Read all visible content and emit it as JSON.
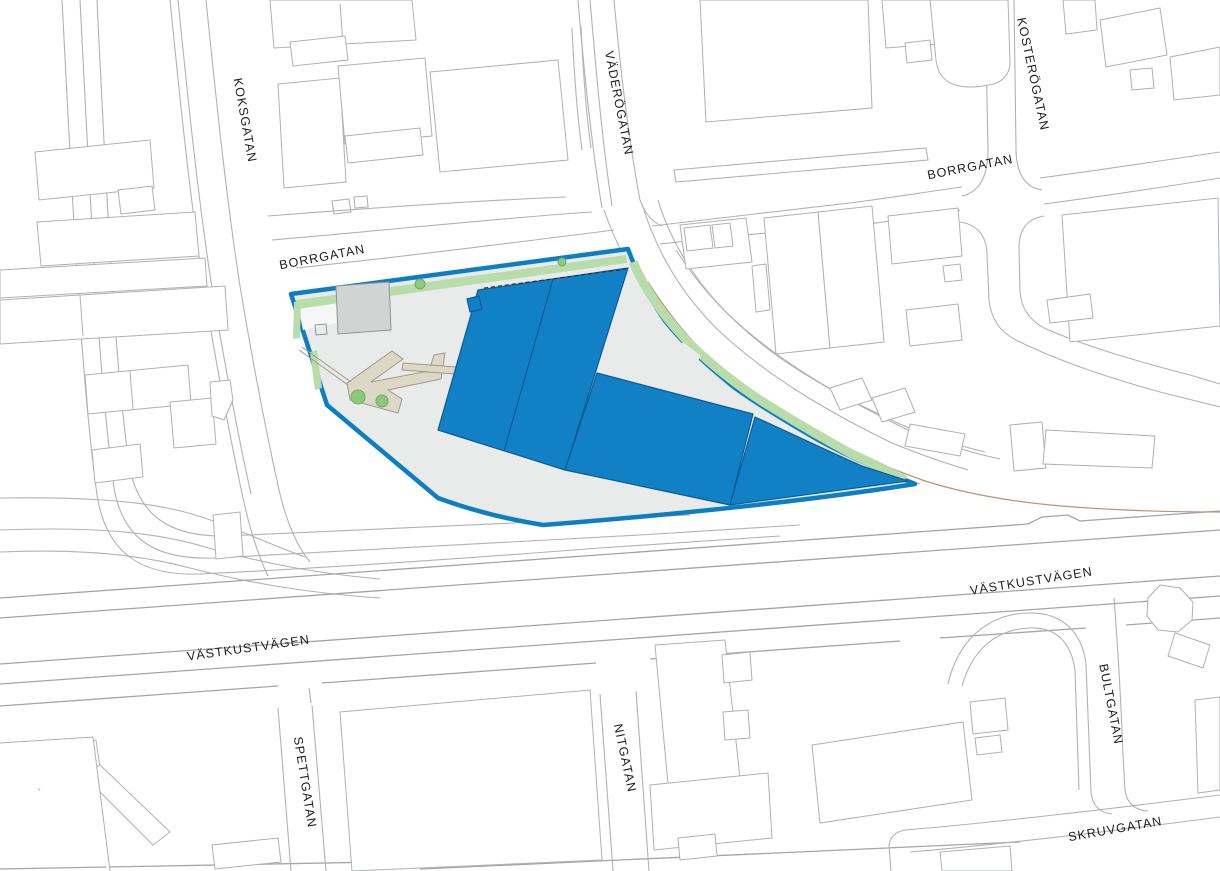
{
  "map": {
    "kind": "site-plan",
    "street_labels": [
      {
        "name": "koksgatan",
        "text": "KOKSGATAN"
      },
      {
        "name": "borrgatan-west",
        "text": "BORRGATAN"
      },
      {
        "name": "vaderogatan",
        "text": "VÄDERÖGATAN"
      },
      {
        "name": "kosterogatan",
        "text": "KOSTERÖGATAN"
      },
      {
        "name": "borrgatan-east",
        "text": "BORRGATAN"
      },
      {
        "name": "vastkustvagen-west",
        "text": "VÄSTKUSTVÄGEN"
      },
      {
        "name": "vastkustvagen-east",
        "text": "VÄSTKUSTVÄGEN"
      },
      {
        "name": "spettgatan",
        "text": "SPETTGATAN"
      },
      {
        "name": "nitgatan",
        "text": "NITGATAN"
      },
      {
        "name": "bultgatan",
        "text": "BULTGATAN"
      },
      {
        "name": "skruvgatan",
        "text": "SKRUVGATAN"
      }
    ],
    "colors": {
      "background": "#ffffff",
      "road_line": "#b0b2b4",
      "highway_line": "#a3a5a7",
      "building_outline": "#aeb0b2",
      "label_text": "#1d1d1b",
      "site_boundary_blue": "#0e7ec2",
      "site_parcel_fill": "#e9ebeb",
      "proposed_building_blue": "#1180c5",
      "proposed_building_edge": "#0a5d94",
      "green_strip": "#b9dcab",
      "tree_green": "#8cc87e",
      "path_beige": "#ddd7c5",
      "existing_building_gray": "#d2d4d4",
      "utility_line_brown": "#bd9275"
    }
  }
}
